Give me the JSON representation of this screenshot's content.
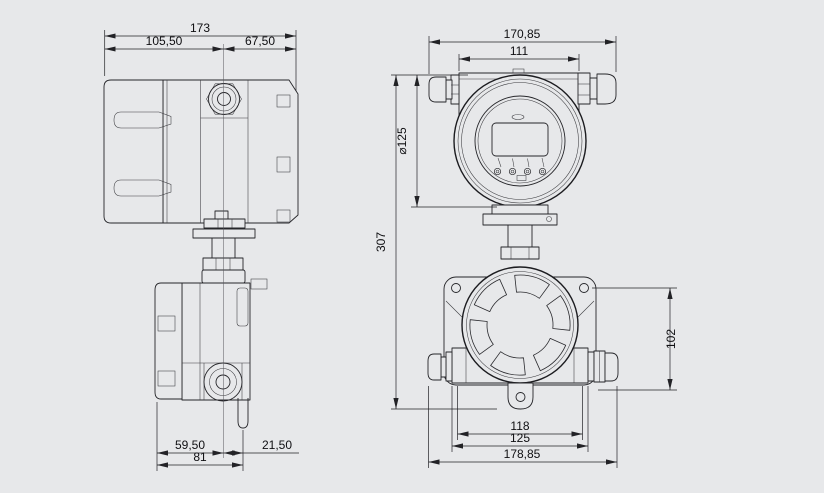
{
  "colors": {
    "background": "#e7e8ea",
    "line": "#222226"
  },
  "side_view": {
    "dim_total_width": "173",
    "dim_width_left": "105,50",
    "dim_width_right": "67,50",
    "dim_bottom_left": "59,50",
    "dim_bottom_right": "21,50",
    "dim_bottom_total": "81"
  },
  "front_view": {
    "dim_total_width": "170,85",
    "dim_housing_width": "111",
    "dim_head_diameter": "⌀125",
    "dim_total_height": "307",
    "dim_sensor_height": "102",
    "dim_hole_spacing": "118",
    "dim_bracket_width": "125",
    "dim_bottom_width": "178,85"
  }
}
